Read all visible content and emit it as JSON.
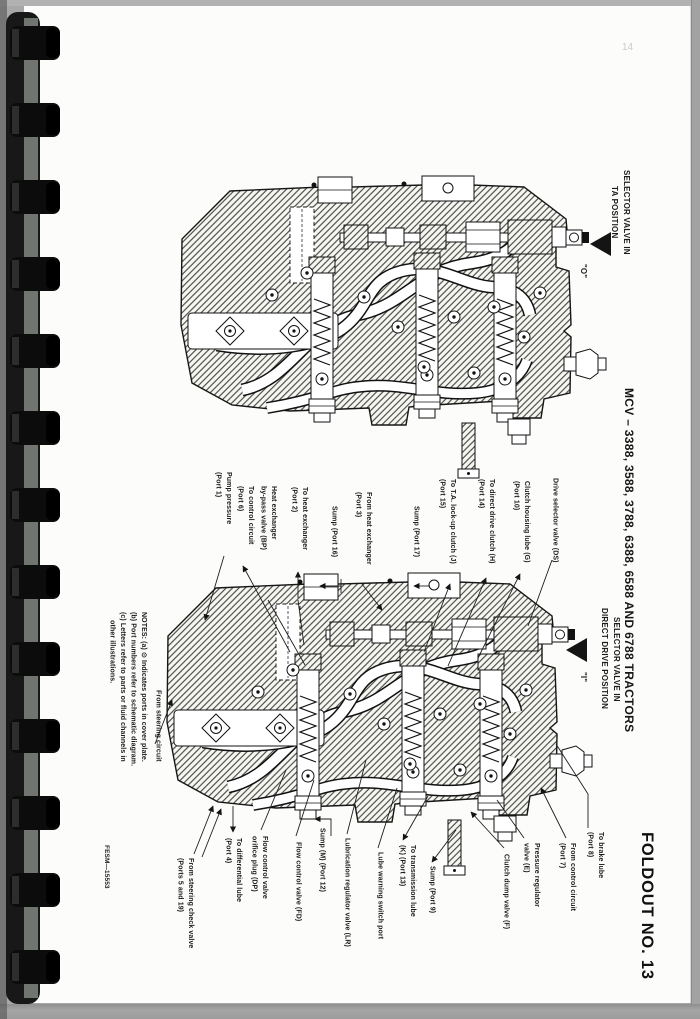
{
  "page": {
    "pencil_page_number": "14",
    "document_code": "FESM—15553",
    "foldout_label": "FOLDOUT NO. 13",
    "rotated_title": "MCV – 3388, 3588, 3788, 6388, 6588 AND 6788 TRACTORS"
  },
  "top_diagram": {
    "caption": "SELECTOR VALVE IN\nTA POSITION",
    "position_letter": "\"O\""
  },
  "bottom_diagram": {
    "caption": "SELECTOR VALVE IN\nDIRECT DRIVE POSITION",
    "position_letter": "\"I\"",
    "notes": "NOTES: (a) ⊙ Indicates ports in cover plate.\n(b) Port numbers refer to schematic diagram.\n(c) Letters refer to parts or fluid channels in\n    other illustrations.",
    "labels_top": [
      {
        "text": "Pump pressure\n(Port 1)"
      },
      {
        "text": "To control circuit\n(Port 6)"
      },
      {
        "text": "Heat exchanger\nby-pass valve (BP)"
      },
      {
        "text": "To heat exchanger\n(Port 2)"
      },
      {
        "text": "Sump (Port 16)"
      },
      {
        "text": "From heat exchanger\n(Port 3)"
      },
      {
        "text": "Sump (Port 17)"
      },
      {
        "text": "To T.A. lock-up clutch (J)\n(Port 15)"
      },
      {
        "text": "To direct drive clutch (H)\n(Port 14)"
      },
      {
        "text": "Clutch housing lube (G)\n(Port 10)"
      },
      {
        "text": "Drive selector valve (DS)"
      }
    ],
    "labels_left": [
      {
        "text": "From steering circuit"
      }
    ],
    "labels_bottom": [
      {
        "text": "From steering check valve\n(Ports 5 and 19)"
      },
      {
        "text": "To differential lube\n(Port 4)"
      },
      {
        "text": "Flow control valve\norifice plug (DP)"
      },
      {
        "text": "Flow control valve (FD)"
      },
      {
        "text": "Sump (M) (Port 12)"
      },
      {
        "text": "Lubrication regulator valve (LR)"
      },
      {
        "text": "Lube warning switch port"
      },
      {
        "text": "To transmission lube\n(K) (Port 13)"
      },
      {
        "text": "Sump (Port 9)"
      },
      {
        "text": "Clutch dump valve (F)"
      },
      {
        "text": "Pressure regulator\nvalve (E)"
      },
      {
        "text": "From control circuit\n(Port 7)"
      },
      {
        "text": "To brake lube\n(Port 8)"
      }
    ]
  },
  "colors": {
    "paper": "#fcfcfa",
    "scan_background": "#a8a8a8",
    "ink": "#1a1a1a",
    "binding": "#111111"
  }
}
